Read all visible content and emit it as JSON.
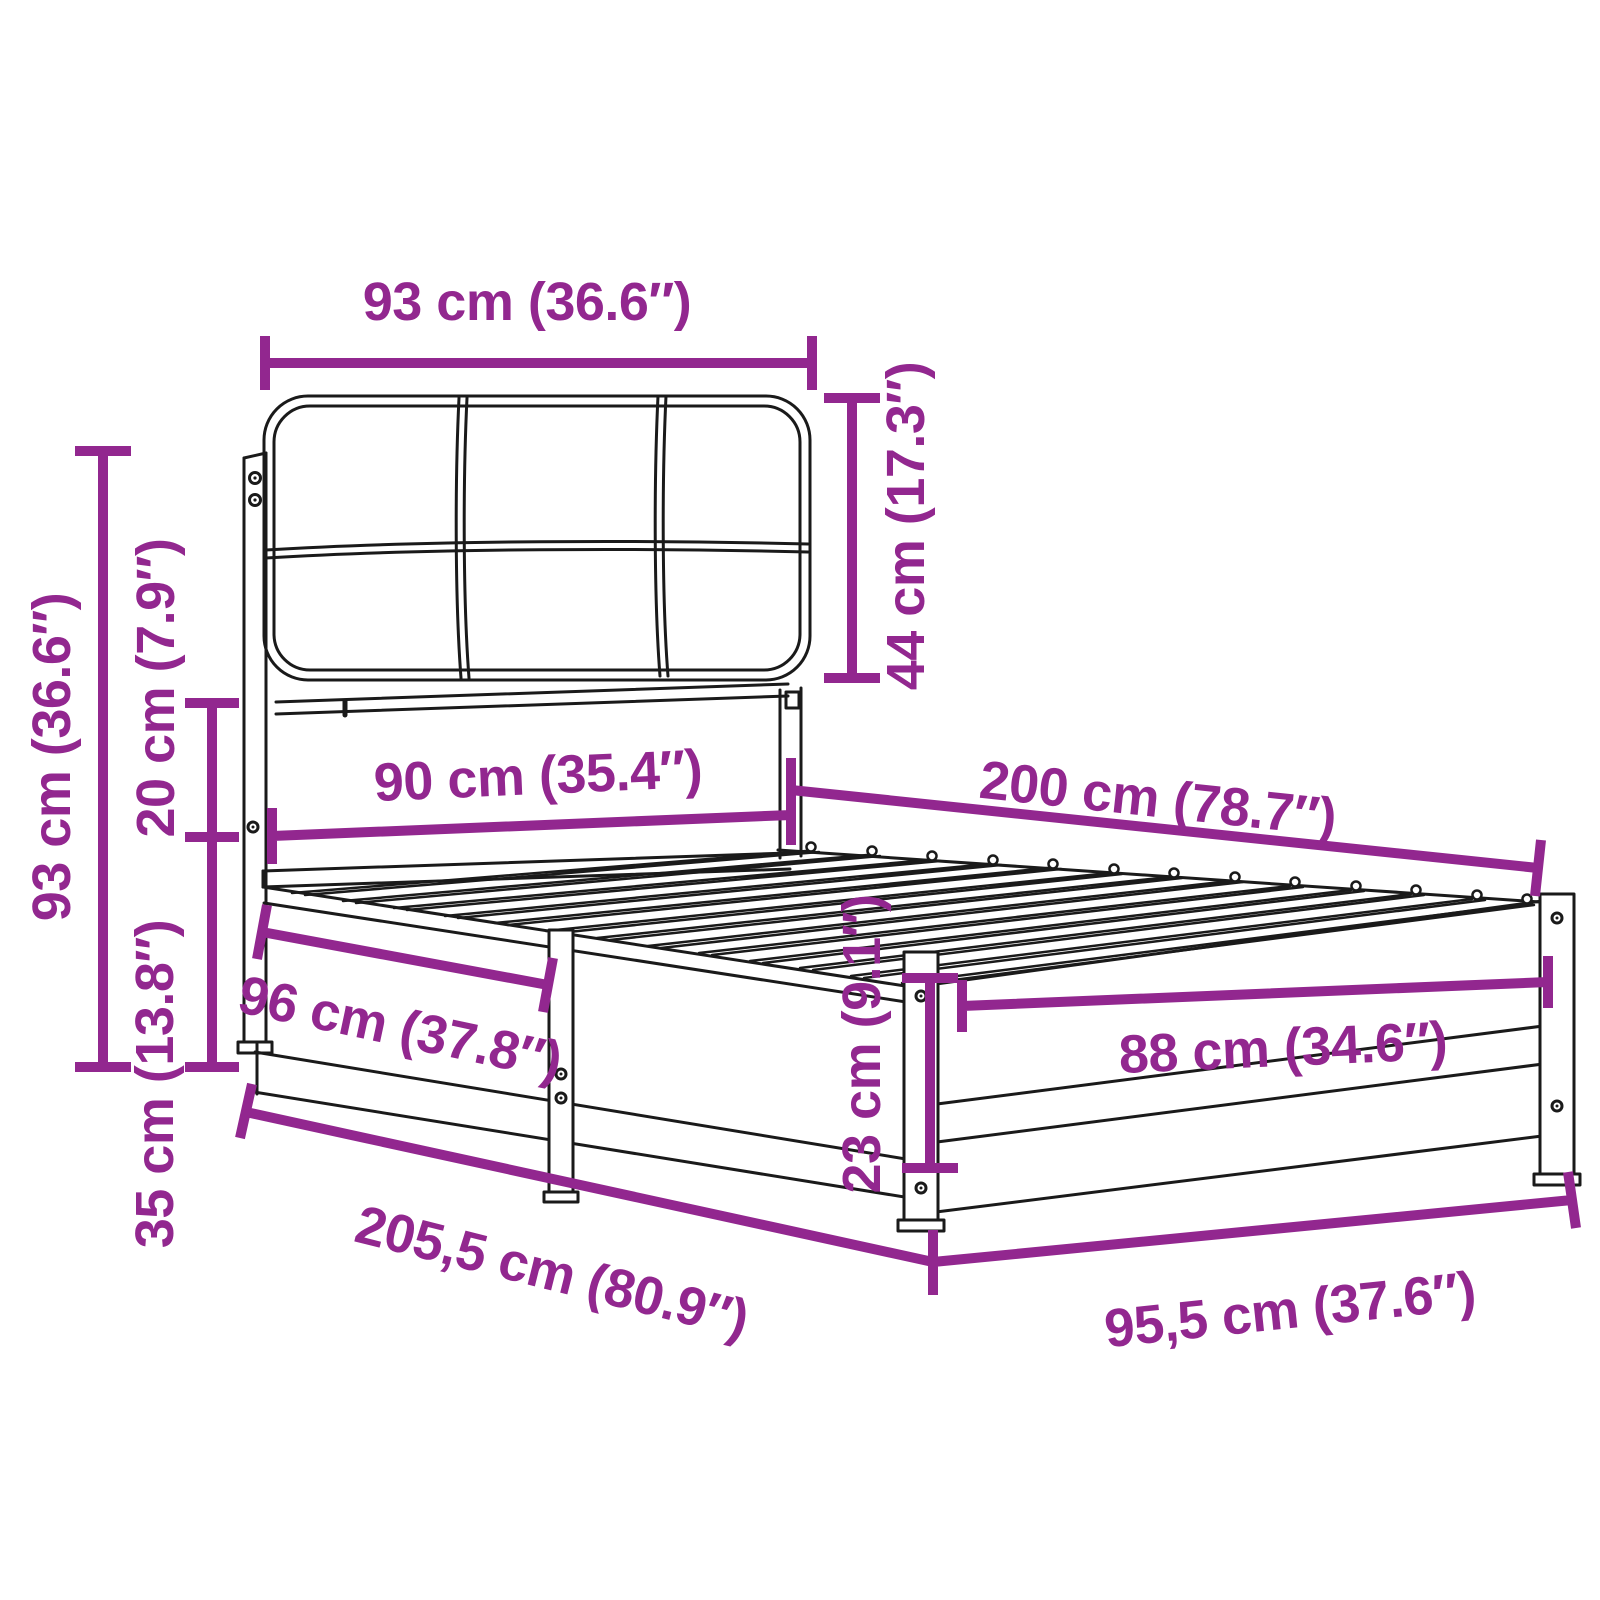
{
  "colors": {
    "accent": "#92278F",
    "line": "#1a1a1a",
    "background": "#ffffff"
  },
  "diagram_type": "bed-frame-dimension-diagram",
  "dimensions": [
    {
      "name": "headboard-width",
      "label": "93 cm (36.6″)"
    },
    {
      "name": "headboard-cushion-height",
      "label": "44 cm (17.3″)"
    },
    {
      "name": "headboard-total-height",
      "label": "93 cm (36.6″)"
    },
    {
      "name": "cushion-to-rail-gap",
      "label": "20 cm (7.9″)"
    },
    {
      "name": "side-rail-height",
      "label": "35 cm (13.8″)"
    },
    {
      "name": "inner-width-head",
      "label": "90 cm (35.4″)"
    },
    {
      "name": "inner-length",
      "label": "200 cm (78.7″)"
    },
    {
      "name": "side-rail-front-segment",
      "label": "96 cm (37.8″)"
    },
    {
      "name": "total-length",
      "label": "205,5 cm (80.9″)"
    },
    {
      "name": "inner-width-foot",
      "label": "88 cm (34.6″)"
    },
    {
      "name": "foot-board-height",
      "label": "23 cm (9.1″)"
    },
    {
      "name": "total-width",
      "label": "95,5 cm (37.6″)"
    }
  ]
}
